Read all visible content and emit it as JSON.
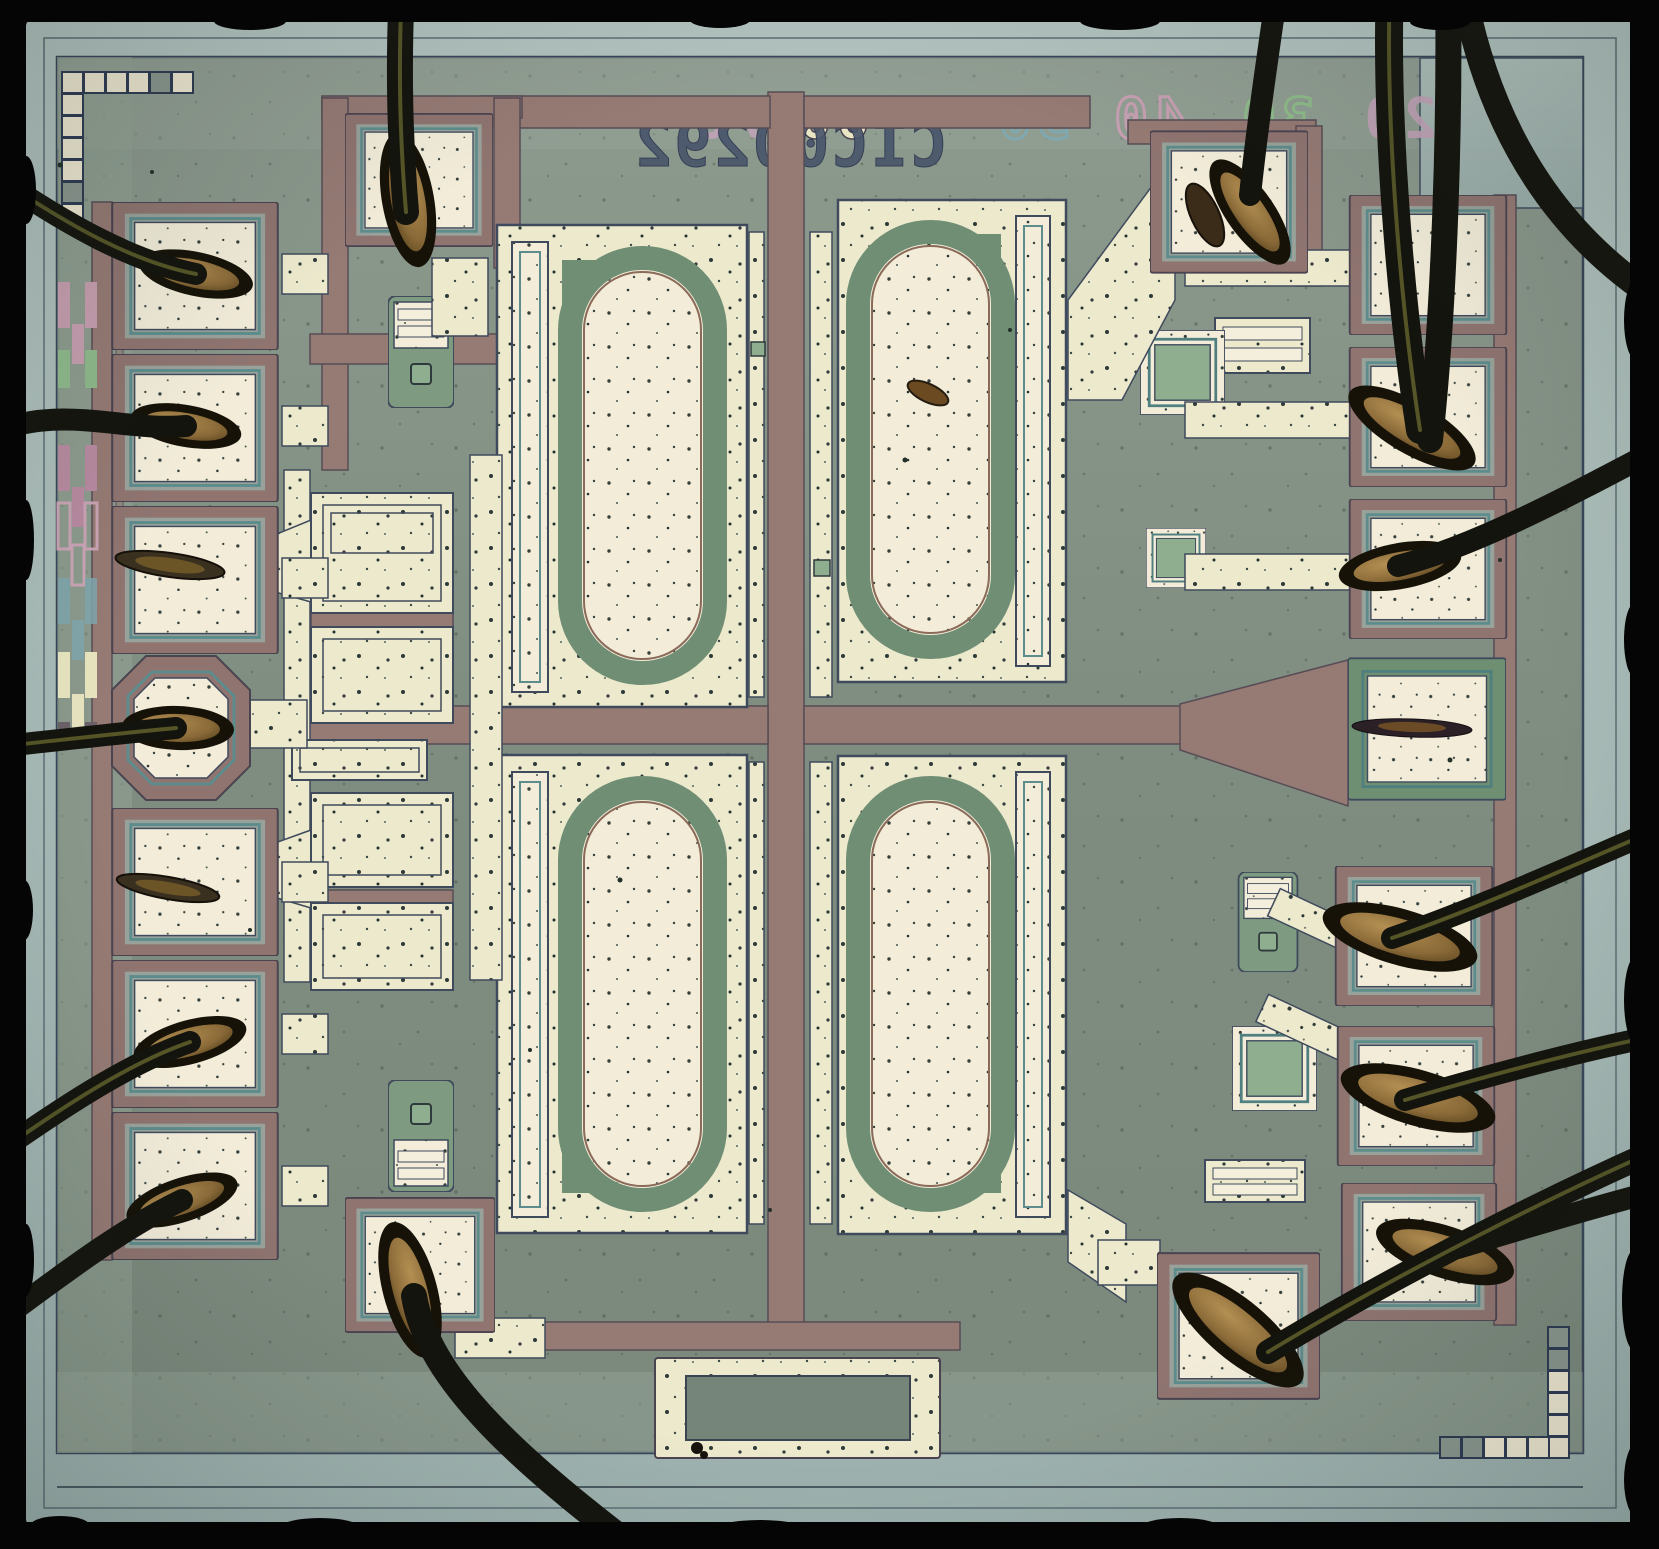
{
  "die_markings": {
    "part_number": "CIC00292",
    "logo_text": "BB",
    "text_mirrored": true,
    "scale_numbers": [
      {
        "value": "70",
        "color": "#c2a3b8"
      },
      {
        "value": "60",
        "color": "#eae6c3"
      },
      {
        "value": "50",
        "color": "#7fa8b0"
      },
      {
        "value": "40",
        "color": "#c79fb2"
      },
      {
        "value": "30",
        "color": "#8fbc8a"
      },
      {
        "value": "20",
        "color": "#c2a3b8"
      }
    ]
  },
  "palette": {
    "photo_background": "#050505",
    "die_rim": "#a7bab7",
    "die_field": "#808e82",
    "metal_cream": "#ece9cd",
    "pad_cream": "#f2ecd9",
    "trace_mauve": "#967a74",
    "junction_green": "#6f8e74",
    "outline_teal": "#5d8c8c",
    "outline_dark": "#3f4a5c",
    "bond_wire": "#15150f",
    "bond_foot_gold": "#8a6a38"
  },
  "features": {
    "bond_pads_left": 7,
    "bond_pads_right": 7,
    "bond_pads_top": 2,
    "bond_pads_bottom": 2,
    "large_stadium_structures": 4
  }
}
